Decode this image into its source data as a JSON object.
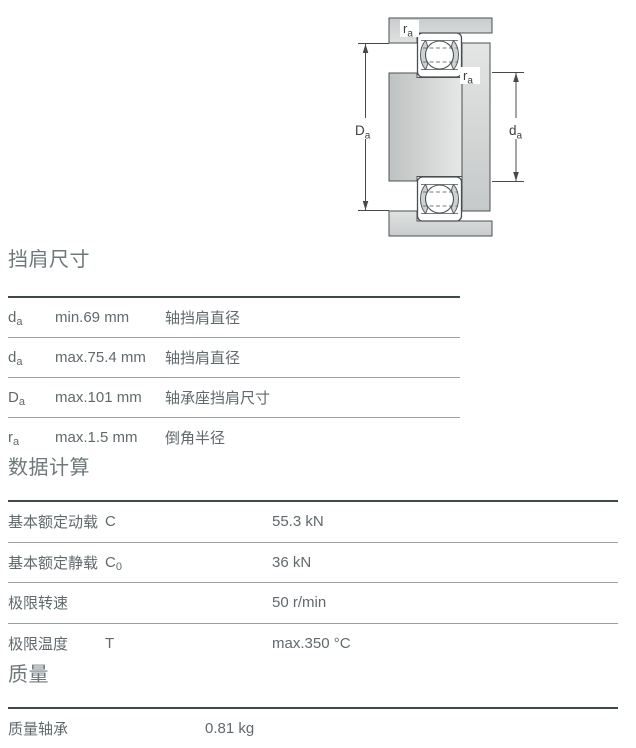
{
  "page": {
    "background": "#ffffff"
  },
  "colors": {
    "heading": "#6e787b",
    "body_text": "#606a6d",
    "border_heavy": "#3e494c",
    "border_light": "#97a1a3",
    "diagram_stroke": "#4a5052",
    "metal_light": "#e3e4e4",
    "metal_dark": "#c3c6c6"
  },
  "diagram": {
    "name": "bearing-abutment-cross-section",
    "labels": {
      "ra_top": {
        "base": "r",
        "sub": "a"
      },
      "ra_right": {
        "base": "r",
        "sub": "a"
      },
      "Da": {
        "base": "D",
        "sub": "a"
      },
      "da": {
        "base": "d",
        "sub": "a"
      }
    }
  },
  "shoulder": {
    "title": "挡肩尺寸",
    "rows": [
      {
        "symbol_base": "d",
        "symbol_sub": "a",
        "value": "min.69 mm",
        "desc": "轴挡肩直径"
      },
      {
        "symbol_base": "d",
        "symbol_sub": "a",
        "value": "max.75.4 mm",
        "desc": "轴挡肩直径"
      },
      {
        "symbol_base": "D",
        "symbol_sub": "a",
        "value": "max.101 mm",
        "desc": "轴承座挡肩尺寸"
      },
      {
        "symbol_base": "r",
        "symbol_sub": "a",
        "value": "max.1.5 mm",
        "desc": "倒角半径"
      }
    ]
  },
  "calculation": {
    "title": "数据计算",
    "rows": [
      {
        "label": "基本额定动载",
        "symbol_base": "C",
        "symbol_sub": "",
        "value": "55.3 kN"
      },
      {
        "label": "基本额定静载",
        "symbol_base": "C",
        "symbol_sub": "0",
        "value": "36 kN"
      },
      {
        "label": "极限转速",
        "symbol_base": "",
        "symbol_sub": "",
        "value": "50 r/min"
      },
      {
        "label": "极限温度",
        "symbol_base": "T",
        "symbol_sub": "",
        "value": "max.350 °C"
      }
    ]
  },
  "mass": {
    "title": "质量",
    "rows": [
      {
        "label": "质量轴承",
        "value": "0.81 kg"
      }
    ]
  }
}
